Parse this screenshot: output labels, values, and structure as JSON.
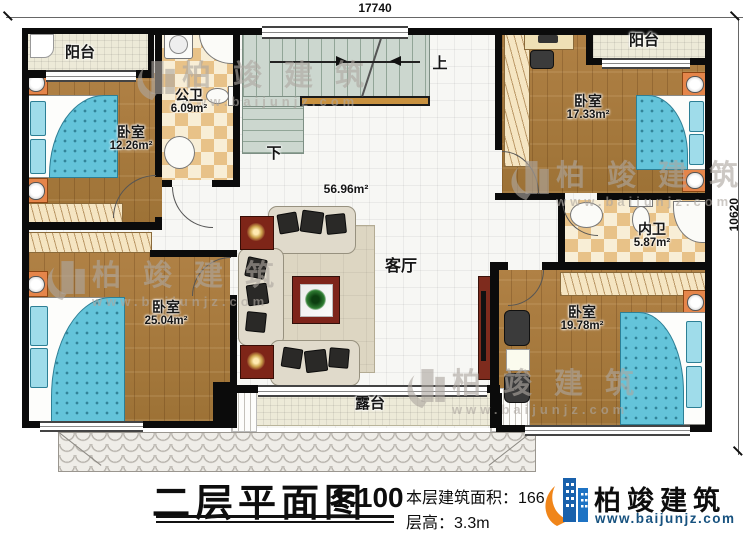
{
  "dimensions": {
    "width": "17740",
    "height": "10620"
  },
  "rooms": {
    "balcony_left": {
      "name": "阳台"
    },
    "balcony_right": {
      "name": "阳台"
    },
    "bath_public": {
      "name": "公卫",
      "area": "6.09m²"
    },
    "bath_inner": {
      "name": "内卫",
      "area": "5.87m²"
    },
    "bedroom_top_left": {
      "name": "卧室",
      "area": "12.26m²"
    },
    "bedroom_bottom_left": {
      "name": "卧室",
      "area": "25.04m²"
    },
    "bedroom_top_right": {
      "name": "卧室",
      "area": "17.33m²"
    },
    "bedroom_bottom_right": {
      "name": "卧室",
      "area": "19.78m²"
    },
    "living": {
      "name": "客厅",
      "area": "56.96m²"
    },
    "terrace": {
      "name": "露台"
    }
  },
  "stairs": {
    "up": "上",
    "down": "下"
  },
  "titleblock": {
    "title": "二层平面图",
    "scale": "1:100",
    "area_line": "本层建筑面积：166.",
    "height_line": "层高：3.3m"
  },
  "brand": {
    "name": "柏竣建筑",
    "url": "www.baijunjz.com"
  },
  "watermark": {
    "name": "柏竣建筑",
    "url": "www.baijunjz.com"
  }
}
